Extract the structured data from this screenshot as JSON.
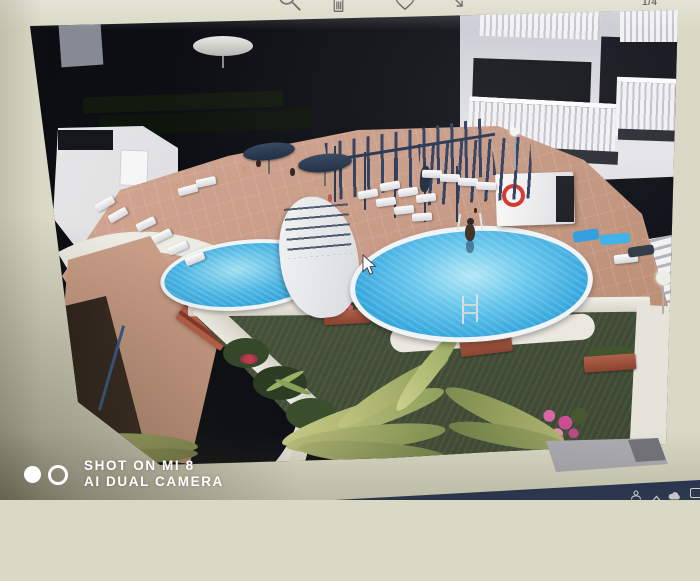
{
  "toolbar": {
    "icons": [
      {
        "name": "zoom-search-icon"
      },
      {
        "name": "delete-trash-icon"
      },
      {
        "name": "favorite-heart-icon"
      },
      {
        "name": "share-edit-icon"
      }
    ],
    "counter": "1/4"
  },
  "watermark": {
    "line1": "SHOT ON MI 8",
    "line2": "AI DUAL CAMERA"
  },
  "taskbar": {
    "tray_icons": [
      "people-icon",
      "chevron-up-icon",
      "cloud-icon",
      "battery-icon-partial"
    ]
  },
  "scene": {
    "description": "Aerial photo of an apartment complex pool terrace: one small and one large round blue pool, white sun loungers, dark navy parasols, blue pergolas, white balconied apartment block, lifebuoy on white pump house, lawn with palm fronds, terracotta flower planters, red brick steps and curved white walls",
    "elements": [
      "small-pool",
      "large-pool",
      "sun-loungers",
      "parasols",
      "pergola",
      "apartment-balconies",
      "lifebuoy",
      "lawn",
      "palm-fronds",
      "flower-planters",
      "brick-steps",
      "walkway",
      "mouse-cursor"
    ]
  },
  "colors": {
    "screen_bg": "#d9d9c5",
    "photo_shadow": "#0c0e13",
    "pool_water": "#2fa3dc",
    "pool_water_light": "#9fdef2",
    "deck_terracotta": "#c79a85",
    "lawn_green": "#46513a",
    "pergola_navy": "#2c3c5c",
    "building_white": "#e6e6ea",
    "taskbar_navy": "#1c2946",
    "planter_terracotta": "#a85c42",
    "lifebuoy_red": "#d2342a",
    "watermark_white": "#ffffff",
    "icon_gray": "#474747"
  }
}
